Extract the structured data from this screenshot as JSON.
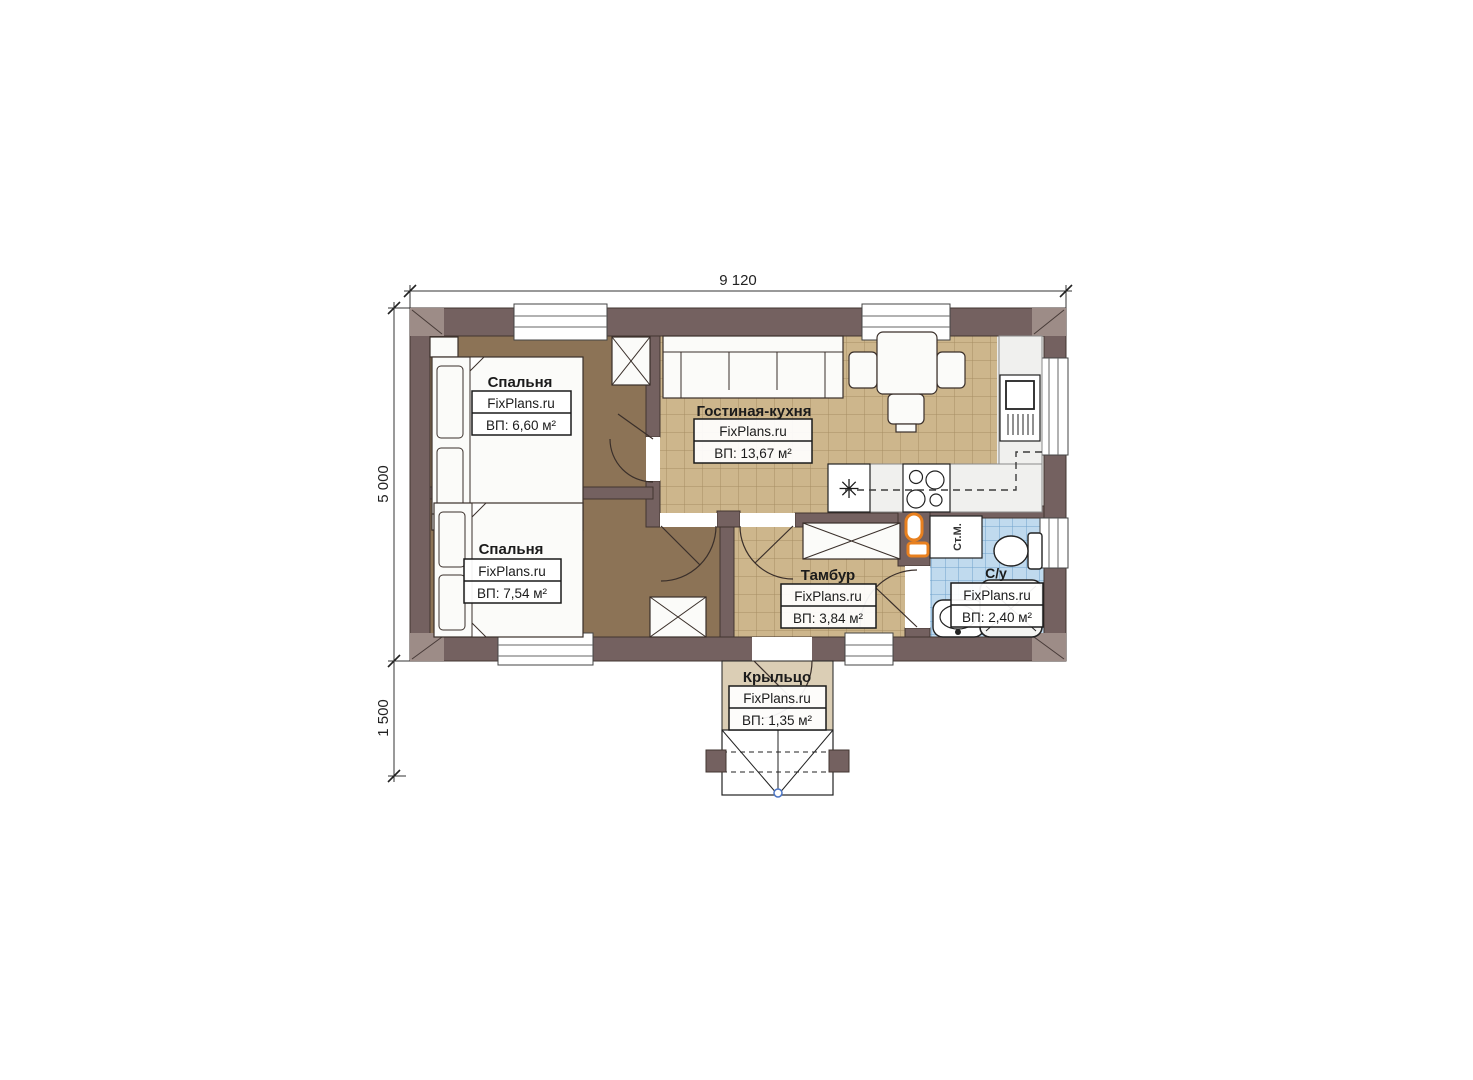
{
  "title": "FixPlans.ru floor plan",
  "dimensions": {
    "top_width": "9 120",
    "left_height": "5 000",
    "porch_height": "1 500"
  },
  "rooms": {
    "bedroom1": {
      "name": "Спальня",
      "brand": "FixPlans.ru",
      "area": "ВП: 6,60 м²"
    },
    "bedroom2": {
      "name": "Спальня",
      "brand": "FixPlans.ru",
      "area": "ВП: 7,54 м²"
    },
    "living_kitchen": {
      "name": "Гостиная-кухня",
      "brand": "FixPlans.ru",
      "area": "ВП: 13,67 м²"
    },
    "vestibule": {
      "name": "Тамбур",
      "brand": "FixPlans.ru",
      "area": "ВП: 3,84 м²"
    },
    "bathroom": {
      "name": "С/у",
      "brand": "FixPlans.ru",
      "area": "ВП: 2,40 м²"
    },
    "porch": {
      "name": "Крыльцо",
      "brand": "FixPlans.ru",
      "area": "ВП: 1,35 м²"
    }
  },
  "appliances": {
    "washing_machine_label": "Ст.М.",
    "fridge_symbol": "✳"
  },
  "colors": {
    "wall": "#746160",
    "bedroom_floor": "#8c7356",
    "living_tile": "#cdb68c",
    "bath_tile": "#c0daee",
    "porch_floor": "#dbceb5",
    "boiler_orange": "#e8801f"
  }
}
